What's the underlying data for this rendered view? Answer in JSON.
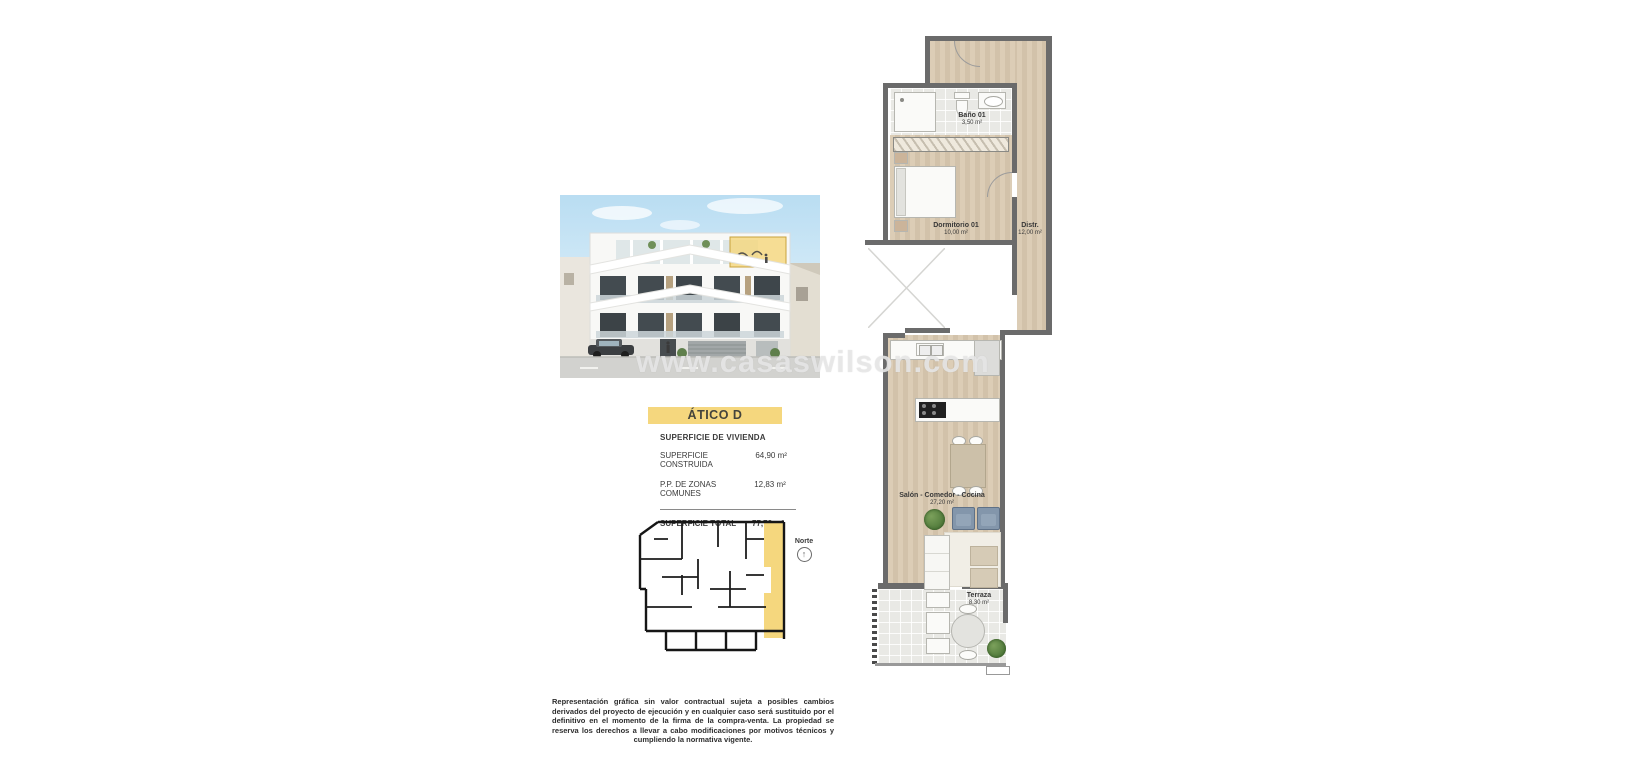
{
  "watermark": {
    "text": "www.casaswilson.com"
  },
  "listing": {
    "banner": "ÁTICO D",
    "surface": {
      "heading": "SUPERFICIE DE VIVIENDA",
      "rows": [
        {
          "label": "SUPERFICIE CONSTRUIDA",
          "value": "64,90 m²"
        },
        {
          "label": "P.P. DE ZONAS COMUNES",
          "value": "12,83 m²"
        }
      ],
      "total_label": "SUPERFICIE TOTAL",
      "total_value": "77,73 m²"
    }
  },
  "key_plan": {
    "north_label": "Norte",
    "north_arrow": "↑"
  },
  "floor_plan": {
    "rooms": [
      {
        "name": "Baño 01",
        "area": "3,50 m²"
      },
      {
        "name": "Dormitorio 01",
        "area": "10,00 m²"
      },
      {
        "name": "Distr.",
        "area": "12,00 m²"
      },
      {
        "name": "Salón - Comedor - Cocina",
        "area": "27,20 m²"
      },
      {
        "name": "Terraza",
        "area": "8,30 m²"
      }
    ]
  },
  "disclaimer": {
    "text": "Representación gráfica sin valor contractual sujeta a posibles cambios derivados del proyecto de ejecución y en cualquier caso será sustituido por el definitivo en el momento de la firma de la compra-venta. La propiedad se reserva los derechos a llevar a cabo modificaciones por motivos técnicos y cumpliendo la normativa vigente."
  },
  "colors": {
    "accent_yellow": "#F5D77E",
    "wall_gray": "#6B6B6B",
    "wood_floor": "#D8C9B2",
    "tile": "#E9E9E5"
  }
}
